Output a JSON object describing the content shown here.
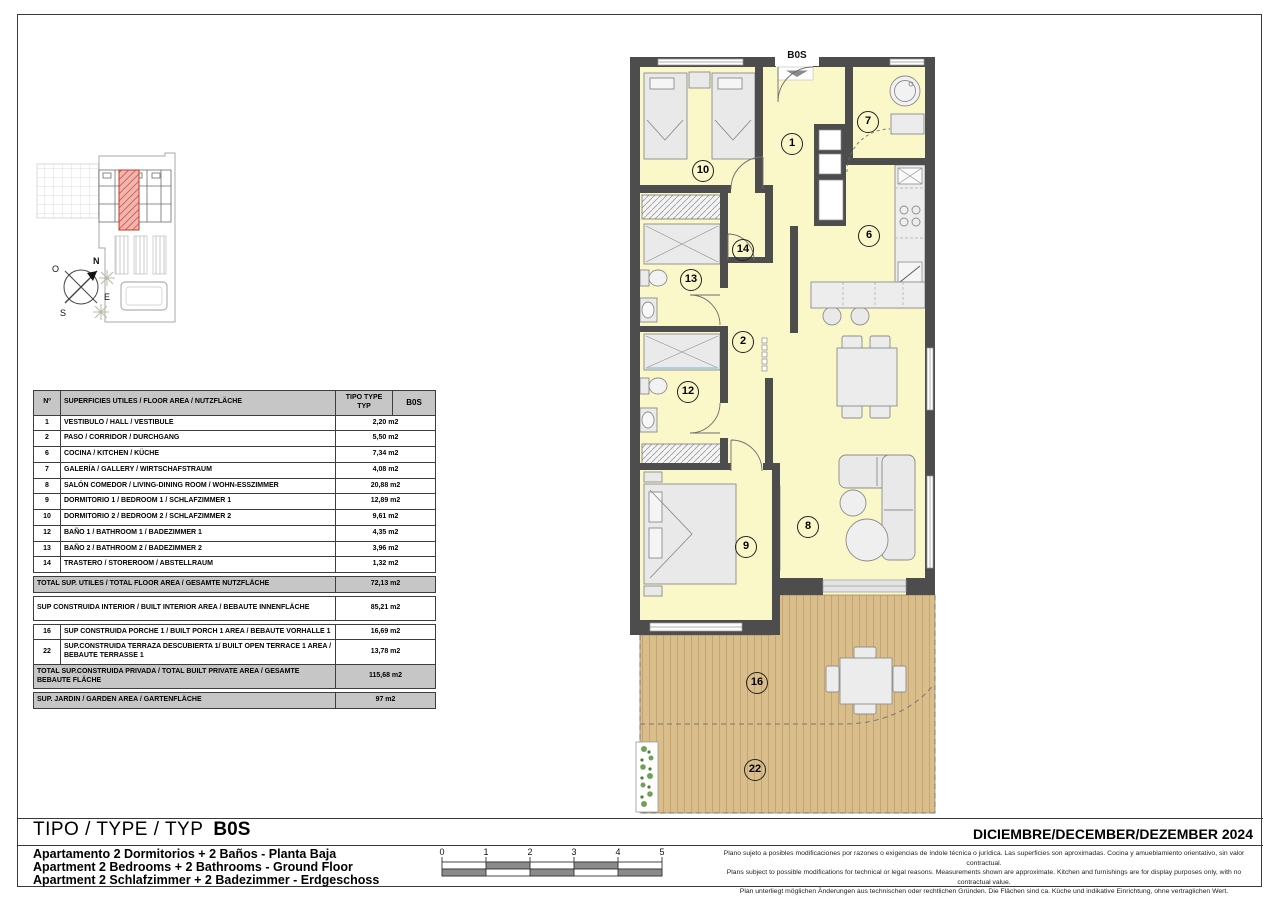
{
  "sheet": {
    "type_label": "TIPO / TYPE / TYP",
    "type_code": "B0S",
    "date": "DICIEMBRE/DECEMBER/DEZEMBER 2024",
    "titles": [
      "Apartamento 2 Dormitorios + 2 Baños - Planta Baja",
      "Apartment 2 Bedrooms + 2 Bathrooms - Ground Floor",
      "Apartment 2 Schlafzimmer + 2 Badezimmer - Erdgeschoss"
    ],
    "disclaimer": [
      "Plano sujeto a posibles modificaciones por razones o exigencias de índole técnica o jurídica. Las superficies son aproximadas. Cocina y amueblamiento orientativo, sin valor contractual.",
      "Plans subject to possible modifications for technical or legal reasons. Measurements shown are approximate. Kitchen and furnishings are for display purposes only, with no contractual value.",
      "Plan unterliegt möglichen Änderungen aus technischen oder rechtlichen Gründen. Die Flächen sind ca. Küche und indikative Einrichtung, ohne vertraglichen Wert."
    ]
  },
  "table": {
    "header": {
      "col_num": "Nº",
      "col_desc": "SUPERFICIES UTILES / FLOOR AREA / NUTZFLÄCHE",
      "col_tipo": "TIPO TYPE TYP",
      "col_code": "B0S"
    },
    "rows": [
      {
        "kind": "item",
        "n": "1",
        "label": "VESTIBULO / HALL  / VESTIBULE",
        "value": "2,20 m2"
      },
      {
        "kind": "item",
        "n": "2",
        "label": "PASO  / CORRIDOR / DURCHGANG",
        "value": "5,50 m2"
      },
      {
        "kind": "item",
        "n": "6",
        "label": "COCINA  / KITCHEN / KÜCHE",
        "value": "7,34 m2"
      },
      {
        "kind": "item",
        "n": "7",
        "label": "GALERÍA / GALLERY / WIRTSCHAFSTRAUM",
        "value": "4,08 m2"
      },
      {
        "kind": "item",
        "n": "8",
        "label": "SALÓN COMEDOR / LIVING-DINING ROOM / WOHN-ESSZIMMER",
        "value": "20,88 m2"
      },
      {
        "kind": "item",
        "n": "9",
        "label": "DORMITORIO 1 / BEDROOM 1 / SCHLAFZIMMER 1",
        "value": "12,89 m2"
      },
      {
        "kind": "item",
        "n": "10",
        "label": "DORMITORIO 2 / BEDROOM 2 / SCHLAFZIMMER 2",
        "value": "9,61 m2"
      },
      {
        "kind": "item",
        "n": "12",
        "label": "BAÑO 1 / BATHROOM 1 / BADEZIMMER 1",
        "value": "4,35 m2"
      },
      {
        "kind": "item",
        "n": "13",
        "label": "BAÑO 2 / BATHROOM 2  / BADEZIMMER 2",
        "value": "3,96 m2"
      },
      {
        "kind": "item",
        "n": "14",
        "label": "TRASTERO / STOREROOM / ABSTELLRAUM",
        "value": "1,32 m2"
      },
      {
        "kind": "gap"
      },
      {
        "kind": "total",
        "label": "TOTAL SUP. UTILES / TOTAL FLOOR AREA / GESAMTE NUTZFLÄCHE",
        "value": "72,13 m2"
      },
      {
        "kind": "gap"
      },
      {
        "kind": "plain",
        "label": "SUP CONSTRUIDA INTERIOR / BUILT INTERIOR AREA / BEBAUTE INNENFLÄCHE",
        "value": "85,21 m2"
      },
      {
        "kind": "gap"
      },
      {
        "kind": "item2",
        "n": "16",
        "label": "SUP CONSTRUIDA PORCHE 1 / BUILT PORCH 1 AREA / BEBAUTE VORHALLE 1",
        "value": "16,69 m2"
      },
      {
        "kind": "item2",
        "n": "22",
        "label": "SUP.CONSTRUIDA TERRAZA DESCUBIERTA 1/ BUILT OPEN TERRACE  1 AREA / BEBAUTE TERRASSE 1",
        "value": "13,78 m2"
      },
      {
        "kind": "total",
        "label": "TOTAL SUP.CONSTRUIDA PRIVADA / TOTAL  BUILT PRIVATE AREA / GESAMTE BEBAUTE FLÄCHE",
        "value": "115,68 m2"
      },
      {
        "kind": "gap"
      },
      {
        "kind": "total",
        "label": "SUP. JARDIN / GARDEN AREA / GARTENFLÄCHE",
        "value": "97 m2"
      }
    ]
  },
  "plan": {
    "entry_label": "B0S",
    "badges": [
      {
        "n": "1"
      },
      {
        "n": "2"
      },
      {
        "n": "6"
      },
      {
        "n": "7"
      },
      {
        "n": "8"
      },
      {
        "n": "9"
      },
      {
        "n": "10"
      },
      {
        "n": "12"
      },
      {
        "n": "13"
      },
      {
        "n": "14"
      },
      {
        "n": "16"
      },
      {
        "n": "22"
      }
    ]
  },
  "scale_bar": {
    "labels": [
      "0",
      "1",
      "2",
      "3",
      "4",
      "5"
    ]
  },
  "compass": {
    "labels": {
      "n": "N",
      "o": "O",
      "e": "E",
      "s": "S"
    }
  },
  "colors": {
    "room_fill": "#FAF7C9",
    "deck_fill": "#D9BE8C",
    "wall": "#4D4D4D",
    "highlight_unit": "#E2726B",
    "table_header_bg": "#C6C6C6"
  }
}
